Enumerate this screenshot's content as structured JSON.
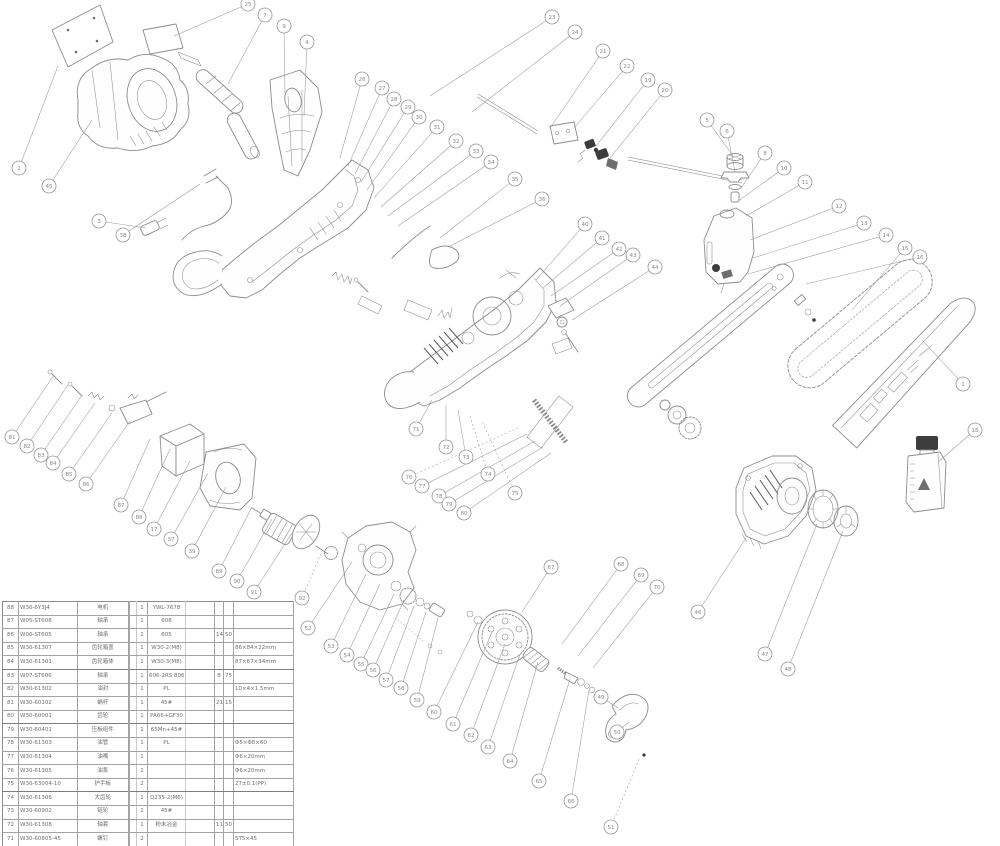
{
  "document": {
    "kind": "chainsaw exploded-parts diagram",
    "background": "#ffffff",
    "line_color": "#8c8c8c",
    "dark_accent": "#3c3c3c"
  },
  "balloons": [
    {
      "n": "2",
      "x": 19,
      "y": 168,
      "tx": 58,
      "ty": 66
    },
    {
      "n": "45",
      "x": 49,
      "y": 186,
      "tx": 92,
      "ty": 120
    },
    {
      "n": "3",
      "x": 99,
      "y": 221,
      "tx": 146,
      "ty": 228
    },
    {
      "n": "38",
      "x": 123,
      "y": 235,
      "tx": 200,
      "ty": 184
    },
    {
      "n": "25",
      "x": 248,
      "y": 4,
      "tx": 174,
      "ty": 36
    },
    {
      "n": "7",
      "x": 265,
      "y": 15,
      "tx": 228,
      "ty": 84
    },
    {
      "n": "9",
      "x": 284,
      "y": 26,
      "tx": 285,
      "ty": 94
    },
    {
      "n": "4",
      "x": 307,
      "y": 42,
      "tx": 304,
      "ty": 116
    },
    {
      "n": "26",
      "x": 362,
      "y": 79,
      "tx": 340,
      "ty": 158
    },
    {
      "n": "27",
      "x": 382,
      "y": 88,
      "tx": 348,
      "ty": 166
    },
    {
      "n": "28",
      "x": 394,
      "y": 99,
      "tx": 355,
      "ty": 174
    },
    {
      "n": "29",
      "x": 408,
      "y": 107,
      "tx": 361,
      "ty": 182
    },
    {
      "n": "30",
      "x": 419,
      "y": 117,
      "tx": 367,
      "ty": 190
    },
    {
      "n": "31",
      "x": 437,
      "y": 127,
      "tx": 374,
      "ty": 198
    },
    {
      "n": "32",
      "x": 456,
      "y": 141,
      "tx": 381,
      "ty": 207
    },
    {
      "n": "33",
      "x": 476,
      "y": 151,
      "tx": 388,
      "ty": 216
    },
    {
      "n": "34",
      "x": 491,
      "y": 162,
      "tx": 398,
      "ty": 226
    },
    {
      "n": "35",
      "x": 515,
      "y": 179,
      "tx": 440,
      "ty": 238
    },
    {
      "n": "36",
      "x": 542,
      "y": 199,
      "tx": 450,
      "ty": 246
    },
    {
      "n": "23",
      "x": 552,
      "y": 17,
      "tx": 430,
      "ty": 96
    },
    {
      "n": "24",
      "x": 575,
      "y": 32,
      "tx": 472,
      "ty": 112
    },
    {
      "n": "21",
      "x": 603,
      "y": 51,
      "tx": 550,
      "ty": 128
    },
    {
      "n": "22",
      "x": 627,
      "y": 66,
      "tx": 574,
      "ty": 128
    },
    {
      "n": "19",
      "x": 648,
      "y": 80,
      "tx": 596,
      "ty": 146
    },
    {
      "n": "20",
      "x": 665,
      "y": 90,
      "tx": 610,
      "ty": 158
    },
    {
      "n": "40",
      "x": 585,
      "y": 224,
      "tx": 536,
      "ty": 280
    },
    {
      "n": "41",
      "x": 602,
      "y": 238,
      "tx": 543,
      "ty": 288
    },
    {
      "n": "42",
      "x": 619,
      "y": 249,
      "tx": 551,
      "ty": 296
    },
    {
      "n": "43",
      "x": 633,
      "y": 255,
      "tx": 560,
      "ty": 306
    },
    {
      "n": "44",
      "x": 655,
      "y": 267,
      "tx": 572,
      "ty": 320
    },
    {
      "n": "5",
      "x": 707,
      "y": 120,
      "tx": 733,
      "ty": 156
    },
    {
      "n": "6",
      "x": 727,
      "y": 131,
      "tx": 735,
      "ty": 172
    },
    {
      "n": "8",
      "x": 765,
      "y": 153,
      "tx": 741,
      "ty": 188
    },
    {
      "n": "10",
      "x": 784,
      "y": 168,
      "tx": 737,
      "ty": 202
    },
    {
      "n": "11",
      "x": 805,
      "y": 182,
      "tx": 746,
      "ty": 216
    },
    {
      "n": "12",
      "x": 839,
      "y": 206,
      "tx": 750,
      "ty": 240
    },
    {
      "n": "13",
      "x": 864,
      "y": 223,
      "tx": 753,
      "ty": 258
    },
    {
      "n": "14",
      "x": 886,
      "y": 235,
      "tx": 748,
      "ty": 274
    },
    {
      "n": "15",
      "x": 905,
      "y": 248,
      "tx": 852,
      "ty": 310
    },
    {
      "n": "16",
      "x": 920,
      "y": 257,
      "tx": 806,
      "ty": 284
    },
    {
      "n": "1",
      "x": 963,
      "y": 384,
      "tx": 922,
      "ty": 340
    },
    {
      "n": "18",
      "x": 975,
      "y": 430,
      "tx": 938,
      "ty": 462
    },
    {
      "n": "46",
      "x": 698,
      "y": 612,
      "tx": 746,
      "ty": 538
    },
    {
      "n": "47",
      "x": 765,
      "y": 654,
      "tx": 817,
      "ty": 524
    },
    {
      "n": "48",
      "x": 788,
      "y": 669,
      "tx": 843,
      "ty": 531
    },
    {
      "n": "49",
      "x": 601,
      "y": 697,
      "tx": 618,
      "ty": 708
    },
    {
      "n": "50",
      "x": 617,
      "y": 732,
      "tx": 629,
      "ty": 722
    },
    {
      "n": "51",
      "x": 611,
      "y": 827,
      "tx": 640,
      "ty": 757,
      "d": 1
    },
    {
      "n": "52",
      "x": 308,
      "y": 628,
      "tx": 352,
      "ty": 562
    },
    {
      "n": "53",
      "x": 331,
      "y": 646,
      "tx": 366,
      "ty": 574
    },
    {
      "n": "54",
      "x": 347,
      "y": 655,
      "tx": 380,
      "ty": 584
    },
    {
      "n": "55",
      "x": 361,
      "y": 664,
      "tx": 394,
      "ty": 594
    },
    {
      "n": "56",
      "x": 373,
      "y": 670,
      "tx": 404,
      "ty": 600
    },
    {
      "n": "57",
      "x": 386,
      "y": 680,
      "tx": 414,
      "ty": 606
    },
    {
      "n": "58",
      "x": 401,
      "y": 688,
      "tx": 426,
      "ty": 612
    },
    {
      "n": "59",
      "x": 417,
      "y": 700,
      "tx": 438,
      "ty": 618
    },
    {
      "n": "60",
      "x": 434,
      "y": 712,
      "tx": 478,
      "ty": 622
    },
    {
      "n": "61",
      "x": 453,
      "y": 724,
      "tx": 492,
      "ty": 632
    },
    {
      "n": "62",
      "x": 471,
      "y": 735,
      "tx": 505,
      "ty": 644
    },
    {
      "n": "63",
      "x": 488,
      "y": 747,
      "tx": 520,
      "ty": 654
    },
    {
      "n": "64",
      "x": 510,
      "y": 761,
      "tx": 538,
      "ty": 662
    },
    {
      "n": "65",
      "x": 539,
      "y": 781,
      "tx": 570,
      "ty": 679
    },
    {
      "n": "66",
      "x": 571,
      "y": 801,
      "tx": 589,
      "ty": 690
    },
    {
      "n": "67",
      "x": 551,
      "y": 567,
      "tx": 522,
      "ty": 612
    },
    {
      "n": "68",
      "x": 621,
      "y": 564,
      "tx": 562,
      "ty": 644
    },
    {
      "n": "69",
      "x": 641,
      "y": 575,
      "tx": 578,
      "ty": 656
    },
    {
      "n": "70",
      "x": 657,
      "y": 587,
      "tx": 593,
      "ty": 668
    },
    {
      "n": "71",
      "x": 416,
      "y": 429,
      "tx": 432,
      "ty": 400
    },
    {
      "n": "72",
      "x": 446,
      "y": 447,
      "tx": 446,
      "ty": 405
    },
    {
      "n": "73",
      "x": 466,
      "y": 457,
      "tx": 458,
      "ty": 410
    },
    {
      "n": "74",
      "x": 488,
      "y": 474,
      "tx": 470,
      "ty": 416,
      "d": 1
    },
    {
      "n": "75",
      "x": 515,
      "y": 493,
      "tx": 482,
      "ty": 421,
      "d": 1
    },
    {
      "n": "76",
      "x": 409,
      "y": 477,
      "tx": 518,
      "ty": 428,
      "d": 1
    },
    {
      "n": "77",
      "x": 422,
      "y": 486,
      "tx": 527,
      "ty": 434
    },
    {
      "n": "78",
      "x": 439,
      "y": 496,
      "tx": 535,
      "ty": 441
    },
    {
      "n": "79",
      "x": 449,
      "y": 504,
      "tx": 543,
      "ty": 447
    },
    {
      "n": "80",
      "x": 464,
      "y": 513,
      "tx": 551,
      "ty": 453
    },
    {
      "n": "81",
      "x": 12,
      "y": 437,
      "tx": 54,
      "ty": 375
    },
    {
      "n": "82",
      "x": 27,
      "y": 446,
      "tx": 68,
      "ty": 385
    },
    {
      "n": "83",
      "x": 41,
      "y": 455,
      "tx": 82,
      "ty": 395
    },
    {
      "n": "84",
      "x": 53,
      "y": 463,
      "tx": 95,
      "ty": 403
    },
    {
      "n": "85",
      "x": 69,
      "y": 474,
      "tx": 112,
      "ty": 413
    },
    {
      "n": "86",
      "x": 86,
      "y": 484,
      "tx": 130,
      "ty": 421
    },
    {
      "n": "87",
      "x": 121,
      "y": 505,
      "tx": 150,
      "ty": 439
    },
    {
      "n": "88",
      "x": 139,
      "y": 517,
      "tx": 170,
      "ty": 449
    },
    {
      "n": "17",
      "x": 154,
      "y": 529,
      "tx": 190,
      "ty": 461
    },
    {
      "n": "37",
      "x": 171,
      "y": 539,
      "tx": 208,
      "ty": 473
    },
    {
      "n": "39",
      "x": 192,
      "y": 551,
      "tx": 226,
      "ty": 487
    },
    {
      "n": "89",
      "x": 219,
      "y": 571,
      "tx": 252,
      "ty": 507
    },
    {
      "n": "90",
      "x": 237,
      "y": 581,
      "tx": 272,
      "ty": 519
    },
    {
      "n": "91",
      "x": 254,
      "y": 592,
      "tx": 292,
      "ty": 533
    },
    {
      "n": "92",
      "x": 302,
      "y": 598,
      "tx": 322,
      "ty": 551,
      "d": 1
    }
  ],
  "parts_table": {
    "columns": [
      "no",
      "code",
      "name",
      "",
      "qty",
      "spec",
      "",
      "d1",
      "d2",
      "remark"
    ],
    "rows": [
      {
        "c": [
          "88",
          "W30-6Y3J4",
          "电机",
          "",
          "1",
          "YWL-7678",
          "",
          "",
          "",
          ""
        ],
        "thick": false
      },
      {
        "c": [
          "87",
          "W05-ST608",
          "轴承",
          "",
          "1",
          "608",
          "",
          "",
          "",
          ""
        ],
        "thick": false
      },
      {
        "c": [
          "86",
          "W06-ST605",
          "轴承",
          "",
          "1",
          "605",
          "",
          "14",
          "50",
          ""
        ],
        "thick": false
      },
      {
        "c": [
          "85",
          "W30-61307",
          "齿轮箱盖",
          "",
          "1",
          "W30-2(M8)",
          "",
          "",
          "",
          "86×84×22mm"
        ],
        "thick": false
      },
      {
        "c": [
          "84",
          "W30-61301",
          "齿轮箱体",
          "",
          "1",
          "W30-3(M8)",
          "",
          "",
          "",
          "87×67×34mm"
        ],
        "thick": true
      },
      {
        "c": [
          "83",
          "W07-ST606",
          "轴承",
          "",
          "1",
          "606-2RS 806",
          "",
          "8",
          "75",
          ""
        ],
        "thick": false
      },
      {
        "c": [
          "82",
          "W30-61302",
          "油封",
          "",
          "1",
          "PL",
          "",
          "",
          "",
          "10×4×1.5mm"
        ],
        "thick": false
      },
      {
        "c": [
          "81",
          "W30-60102",
          "蜗杆",
          "",
          "1",
          "45#",
          "",
          "21",
          "15",
          ""
        ],
        "thick": false
      },
      {
        "c": [
          "80",
          "W30-60001",
          "齿轮",
          "",
          "1",
          "PA66+GF30",
          "",
          "",
          "",
          ""
        ],
        "thick": true
      },
      {
        "c": [
          "79",
          "W30-60401",
          "压板组件",
          "",
          "1",
          "65Mn+45#",
          "",
          "",
          "",
          ""
        ],
        "thick": false
      },
      {
        "c": [
          "78",
          "W30-61303",
          "油管",
          "",
          "1",
          "PL",
          "",
          "",
          "",
          "Φ5×Φ8×60"
        ],
        "thick": false
      },
      {
        "c": [
          "77",
          "W30-61304",
          "油嘴",
          "",
          "1",
          "",
          "",
          "",
          "",
          "Φ6×20mm"
        ],
        "thick": false
      },
      {
        "c": [
          "76",
          "W30-61305",
          "油泵",
          "",
          "1",
          "",
          "",
          "",
          "",
          "Φ6×20mm"
        ],
        "thick": false
      },
      {
        "c": [
          "75",
          "W30-63004-10",
          "护手板",
          "",
          "2",
          "",
          "",
          "",
          "",
          "2T±0.1(PP)"
        ],
        "thick": true
      },
      {
        "c": [
          "74",
          "W30-61306",
          "大齿轮",
          "",
          "1",
          "Q235-2(M6)",
          "",
          "",
          "",
          ""
        ],
        "thick": false
      },
      {
        "c": [
          "73",
          "W30-60902",
          "链轮",
          "",
          "1",
          "45#",
          "",
          "",
          "",
          ""
        ],
        "thick": false
      },
      {
        "c": [
          "72",
          "W30-61308",
          "轴套",
          "",
          "1",
          "粉末冶金",
          "",
          "11",
          "50",
          ""
        ],
        "thick": false
      },
      {
        "c": [
          "71",
          "W30-60805-45",
          "螺钉",
          "",
          "2",
          "",
          "",
          "",
          "",
          "ST5×45"
        ],
        "thick": true
      },
      {
        "c": [
          "70",
          "W30-60806",
          "垫圈",
          "",
          "1",
          "",
          "",
          "",
          "",
          ""
        ],
        "thick": false
      }
    ]
  }
}
